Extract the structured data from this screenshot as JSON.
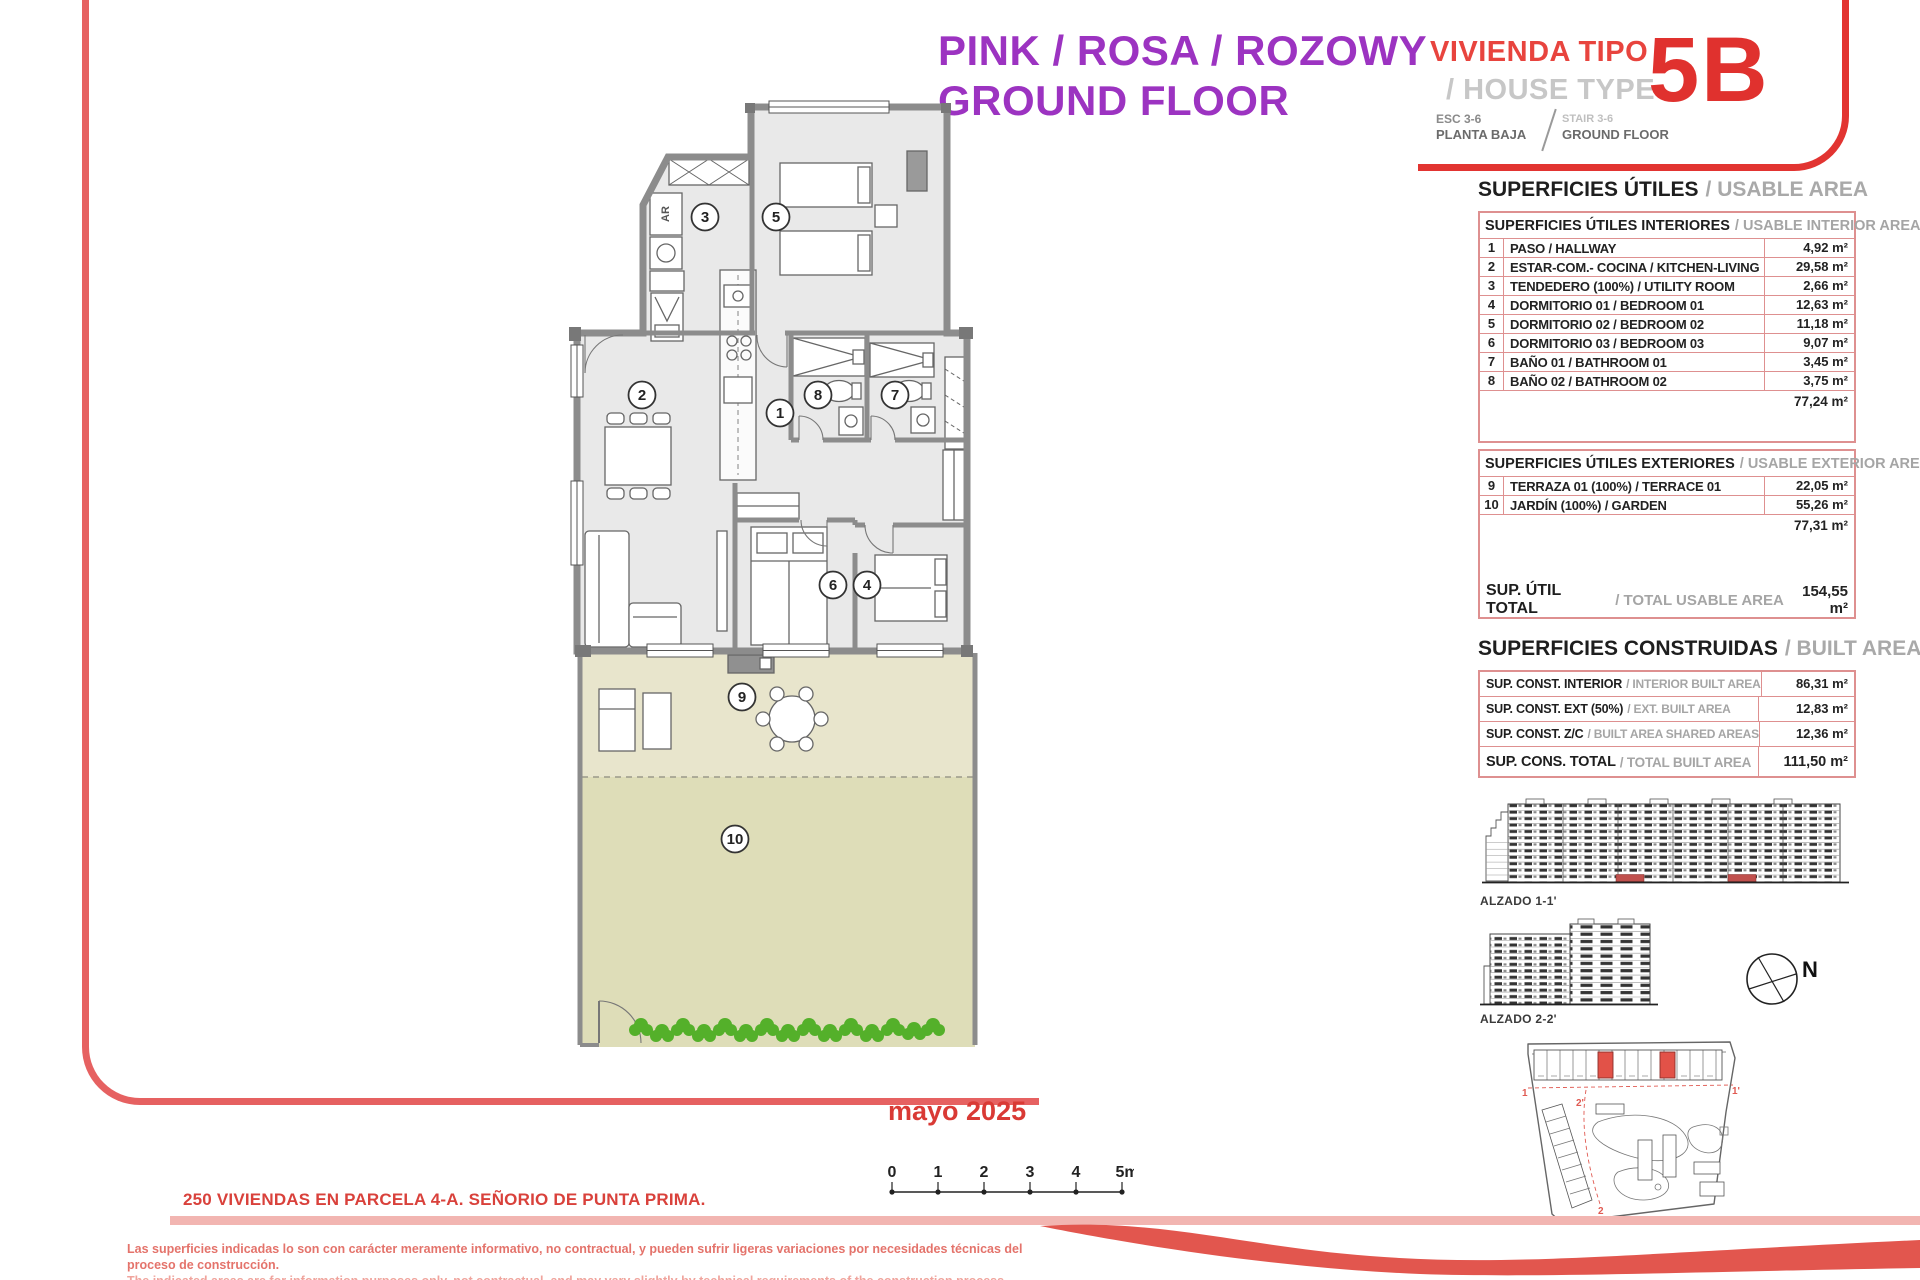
{
  "header": {
    "title_line1": "PINK / ROSA / ROZOWY",
    "title_line2": "GROUND FLOOR",
    "type_label_es": "VIVIENDA TIPO",
    "type_label_en": "/ HOUSE TYPE",
    "type_code": "5B",
    "stair_es_1": "ESC 3-6",
    "stair_es_2": "PLANTA BAJA",
    "stair_en_1": "STAIR 3-6",
    "stair_en_2": "GROUND FLOOR"
  },
  "usable_area": {
    "title_es": "SUPERFICIES ÚTILES",
    "title_en": "/ USABLE AREA",
    "interior_header_es": "SUPERFICIES ÚTILES INTERIORES",
    "interior_header_en": "/ USABLE INTERIOR AREA",
    "interior_rows": [
      {
        "num": "1",
        "label": "PASO / HALLWAY",
        "value": "4,92 m²"
      },
      {
        "num": "2",
        "label": "ESTAR-COM.- COCINA / KITCHEN-LIVING",
        "value": "29,58 m²"
      },
      {
        "num": "3",
        "label": "TENDEDERO (100%) / UTILITY ROOM",
        "value": "2,66 m²"
      },
      {
        "num": "4",
        "label": "DORMITORIO 01 / BEDROOM 01",
        "value": "12,63 m²"
      },
      {
        "num": "5",
        "label": "DORMITORIO 02 / BEDROOM 02",
        "value": "11,18 m²"
      },
      {
        "num": "6",
        "label": "DORMITORIO 03 / BEDROOM 03",
        "value": "9,07 m²"
      },
      {
        "num": "7",
        "label": "BAÑO 01 / BATHROOM 01",
        "value": "3,45 m²"
      },
      {
        "num": "8",
        "label": "BAÑO 02 / BATHROOM 02",
        "value": "3,75 m²"
      }
    ],
    "interior_subtotal": "77,24 m²",
    "exterior_header_es": "SUPERFICIES ÚTILES EXTERIORES",
    "exterior_header_en": "/ USABLE EXTERIOR AREA",
    "exterior_rows": [
      {
        "num": "9",
        "label": "TERRAZA 01 (100%) / TERRACE 01",
        "value": "22,05 m²"
      },
      {
        "num": "10",
        "label": "JARDÍN (100%) / GARDEN",
        "value": "55,26 m²"
      }
    ],
    "exterior_subtotal": "77,31 m²",
    "total_label_es": "SUP. ÚTIL TOTAL",
    "total_label_en": "/ TOTAL USABLE AREA",
    "total_value": "154,55 m²"
  },
  "built_area": {
    "title_es": "SUPERFICIES CONSTRUIDAS",
    "title_en": "/ BUILT AREA",
    "rows": [
      {
        "label_es": "SUP. CONST. INTERIOR",
        "label_en": "/ INTERIOR BUILT AREA",
        "value": "86,31 m²"
      },
      {
        "label_es": "SUP. CONST. EXT (50%)",
        "label_en": "/ EXT. BUILT AREA",
        "value": "12,83 m²"
      },
      {
        "label_es": "SUP. CONST. Z/C",
        "label_en": "/ BUILT AREA SHARED AREAS",
        "value": "12,36 m²"
      }
    ],
    "total_label_es": "SUP. CONS. TOTAL",
    "total_label_en": "/ TOTAL BUILT AREA",
    "total_value": "111,50 m²"
  },
  "plan": {
    "rooms": [
      "1",
      "2",
      "3",
      "4",
      "5",
      "6",
      "7",
      "8",
      "9",
      "10"
    ],
    "utility_label": "AR"
  },
  "elevations": {
    "alzado1_label": "ALZADO 1-1'",
    "alzado2_label": "ALZADO 2-2'",
    "compass_label": "N"
  },
  "site_plan": {
    "markers": [
      "1",
      "1'",
      "2",
      "2'"
    ]
  },
  "footer": {
    "date": "mayo 2025",
    "scale_labels": [
      "0",
      "1",
      "2",
      "3",
      "4",
      "5m"
    ],
    "project_title": "250 VIVIENDAS EN PARCELA 4-A. SEÑORIO DE PUNTA PRIMA.",
    "disclaimer_es": "Las superficies indicadas lo son con carácter meramente informativo, no contractual, y pueden sufrir ligeras variaciones por necesidades técnicas del proceso de construcción.",
    "disclaimer_en": "The indicated areas are for information purposes only, not contractual, and may vary slightly by technical requirements of the construction process."
  },
  "colors": {
    "purple": "#9C33C1",
    "red": "#E8443E",
    "red_dark": "#E0312E",
    "salmon_frame": "#E66161",
    "table_border": "#DE9090",
    "gray_text": "#A5A5A5",
    "floor_fill": "#E9E9E9",
    "terrace_fill": "#E8E5CC",
    "garden_fill": "#DEDDB8",
    "wall_gray": "#8C8C8C",
    "bush_green": "#54B02A",
    "band_pink": "#F2B5B1"
  }
}
